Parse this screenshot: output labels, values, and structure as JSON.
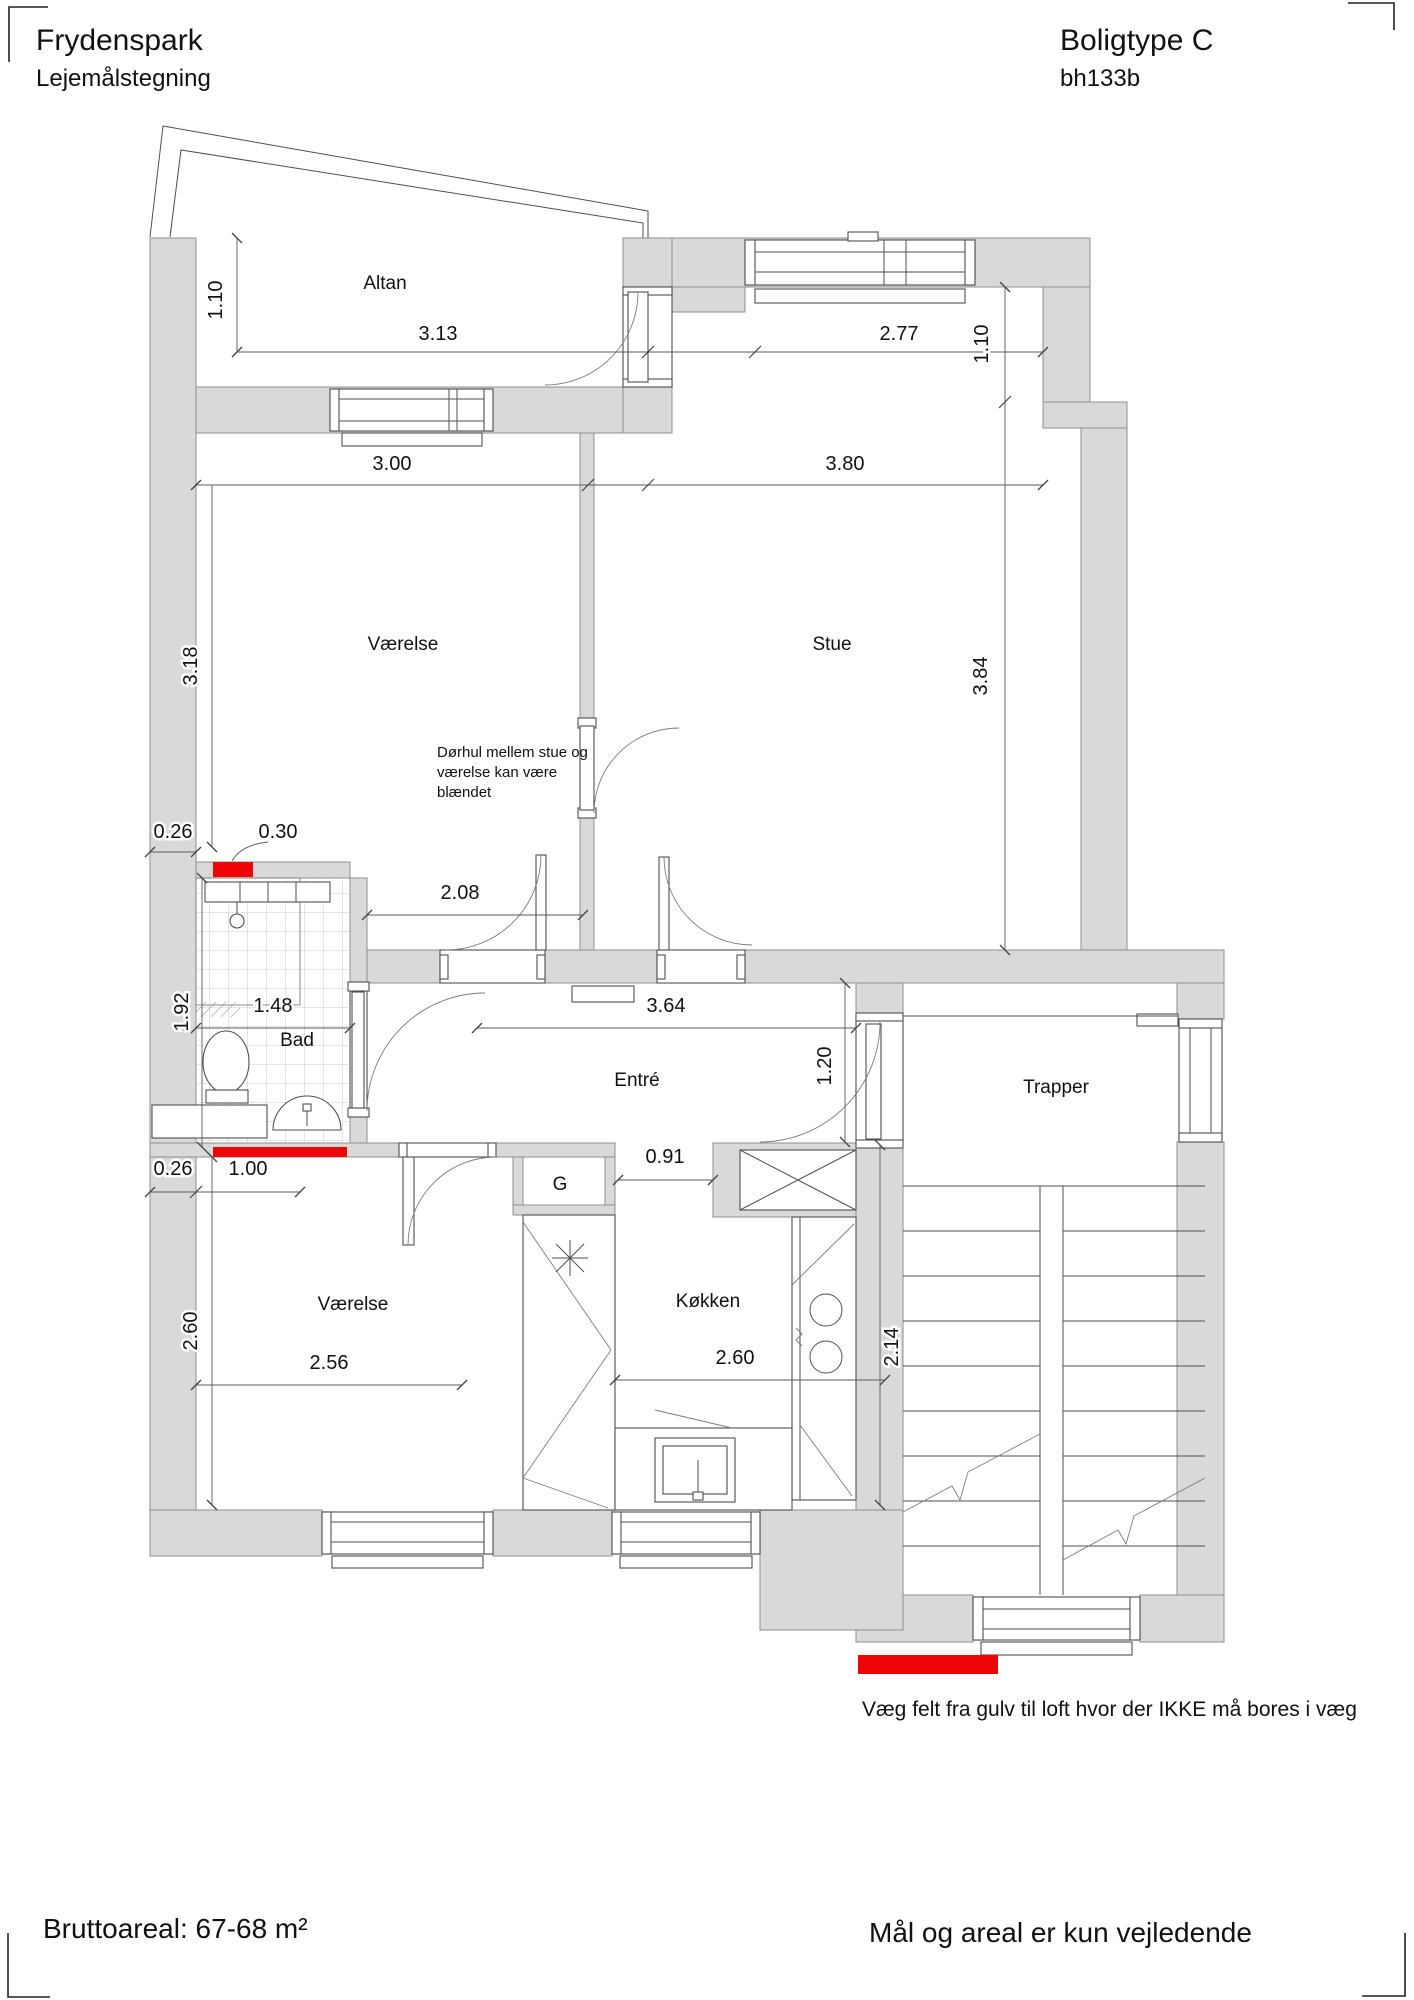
{
  "title_block": {
    "project": "Frydenspark",
    "drawing_type": "Lejemålstegning",
    "housing_type": "Boligtype C",
    "drawing_id": "bh133b"
  },
  "rooms": {
    "altan": "Altan",
    "vaerelse_top": "Værelse",
    "stue": "Stue",
    "bad": "Bad",
    "entre": "Entré",
    "trapper": "Trapper",
    "garderobe": "G",
    "vaerelse_bottom": "Værelse",
    "koekken": "Køkken"
  },
  "dimensions": {
    "altan_depth": "1.10",
    "altan_width": "3.13",
    "stue_top_width": "2.77",
    "right_top_offset": "1.10",
    "vaerelse_top_width": "3.00",
    "stue_width": "3.80",
    "vaerelse_top_height": "3.18",
    "stue_height": "3.84",
    "bad_top_left": "0.26",
    "bad_top_opening": "0.30",
    "vaerelse_doorway": "2.08",
    "bad_height": "1.92",
    "bad_width": "1.48",
    "bad_bottom_left": "0.26",
    "bad_bottom_opening": "1.00",
    "entre_width": "3.64",
    "entry_door": "1.20",
    "kitchen_opening": "0.91",
    "vaerelse_bottom_height": "2.60",
    "vaerelse_bottom_width": "2.56",
    "koekken_width": "2.60",
    "koekken_height": "2.14"
  },
  "annotations": {
    "door_note_line1": "Dørhul mellem stue og",
    "door_note_line2": "værelse kan være",
    "door_note_line3": "blændet",
    "legend": "Væg felt fra gulv til loft hvor der IKKE må bores i væg"
  },
  "footer": {
    "area": "Bruttoareal: 67-68 m²",
    "disclaimer": "Mål og areal er kun vejledende"
  },
  "colors": {
    "wall_fill": "#d9d9d9",
    "no_drill_red": "#ee0505",
    "line": "#4f4f4f"
  }
}
